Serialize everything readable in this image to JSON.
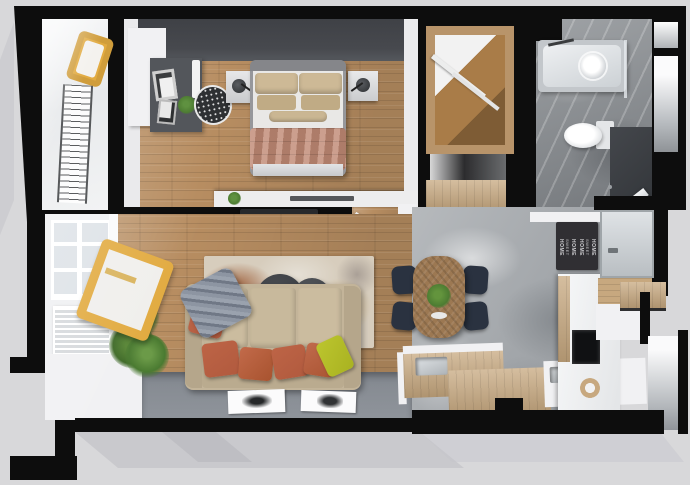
{
  "scene": {
    "description": "Top-down 3D render of a one-bedroom apartment floor plan",
    "view": "top-down",
    "rooms": [
      "balcony",
      "bedroom",
      "hallway-wardrobe",
      "bathroom",
      "living-room",
      "kitchen-dining",
      "entrance"
    ]
  },
  "palette": {
    "bg": "#d8d8da",
    "wall": "#0d0d0d",
    "shadow": "#bfbfc4",
    "white": "#f1f1f3",
    "glass": "#dde2e7",
    "wood": "#b78d61",
    "woodlight": "#c7a87f",
    "woodtable": "#9c7852",
    "charcoal": "#47494e",
    "desk": "#53565b",
    "concrete": "#a6aaae",
    "marble": "#8e9296",
    "tub": "#c3c7cb",
    "duvet": "#c18a75",
    "sheet": "#e9e8e6",
    "pillowbeige": "#cdb996",
    "bedframe": "#96979b",
    "sofa": "#c3b499",
    "rust": "#b15a3e",
    "lime": "#a9b221",
    "throw": "#8d95a2",
    "tabledark": "#3d4045",
    "navy": "#2a3240",
    "green": "#4d7c32",
    "yellow": "#e2ab41",
    "tv": "#27292c",
    "grayfloor": "#878c93",
    "mat": "#302f33",
    "mattext": "#cfcfd2",
    "dresser": "#ededee",
    "radiator": "#d6d9dc"
  },
  "doormat": {
    "line1": "HOME",
    "line2": "SWEET",
    "line3": "HOME"
  },
  "furniture": {
    "balcony": [
      "lounge-chair-yellow",
      "drying-rack"
    ],
    "bedroom": [
      "double-bed",
      "nightstand-left",
      "nightstand-right",
      "desk-unit",
      "picture-frames",
      "laundry-basket",
      "potted-plant",
      "low-dresser"
    ],
    "hallway": [
      "open-wardrobe",
      "storage-niche",
      "shoe-cabinet"
    ],
    "bathroom": [
      "bathtub",
      "shower-head",
      "toilet",
      "bathroom-door"
    ],
    "living_room": [
      "sofa",
      "throw-blanket",
      "cushions",
      "coffee-tables",
      "area-rug",
      "floor-posters",
      "potted-plant",
      "wooden-armchair",
      "radiator",
      "window"
    ],
    "kitchen_dining": [
      "dining-table",
      "dining-chairs",
      "centerpiece-plant",
      "kitchen-counters",
      "sink",
      "cooktop",
      "doormat",
      "entrance-door",
      "threshold"
    ]
  }
}
